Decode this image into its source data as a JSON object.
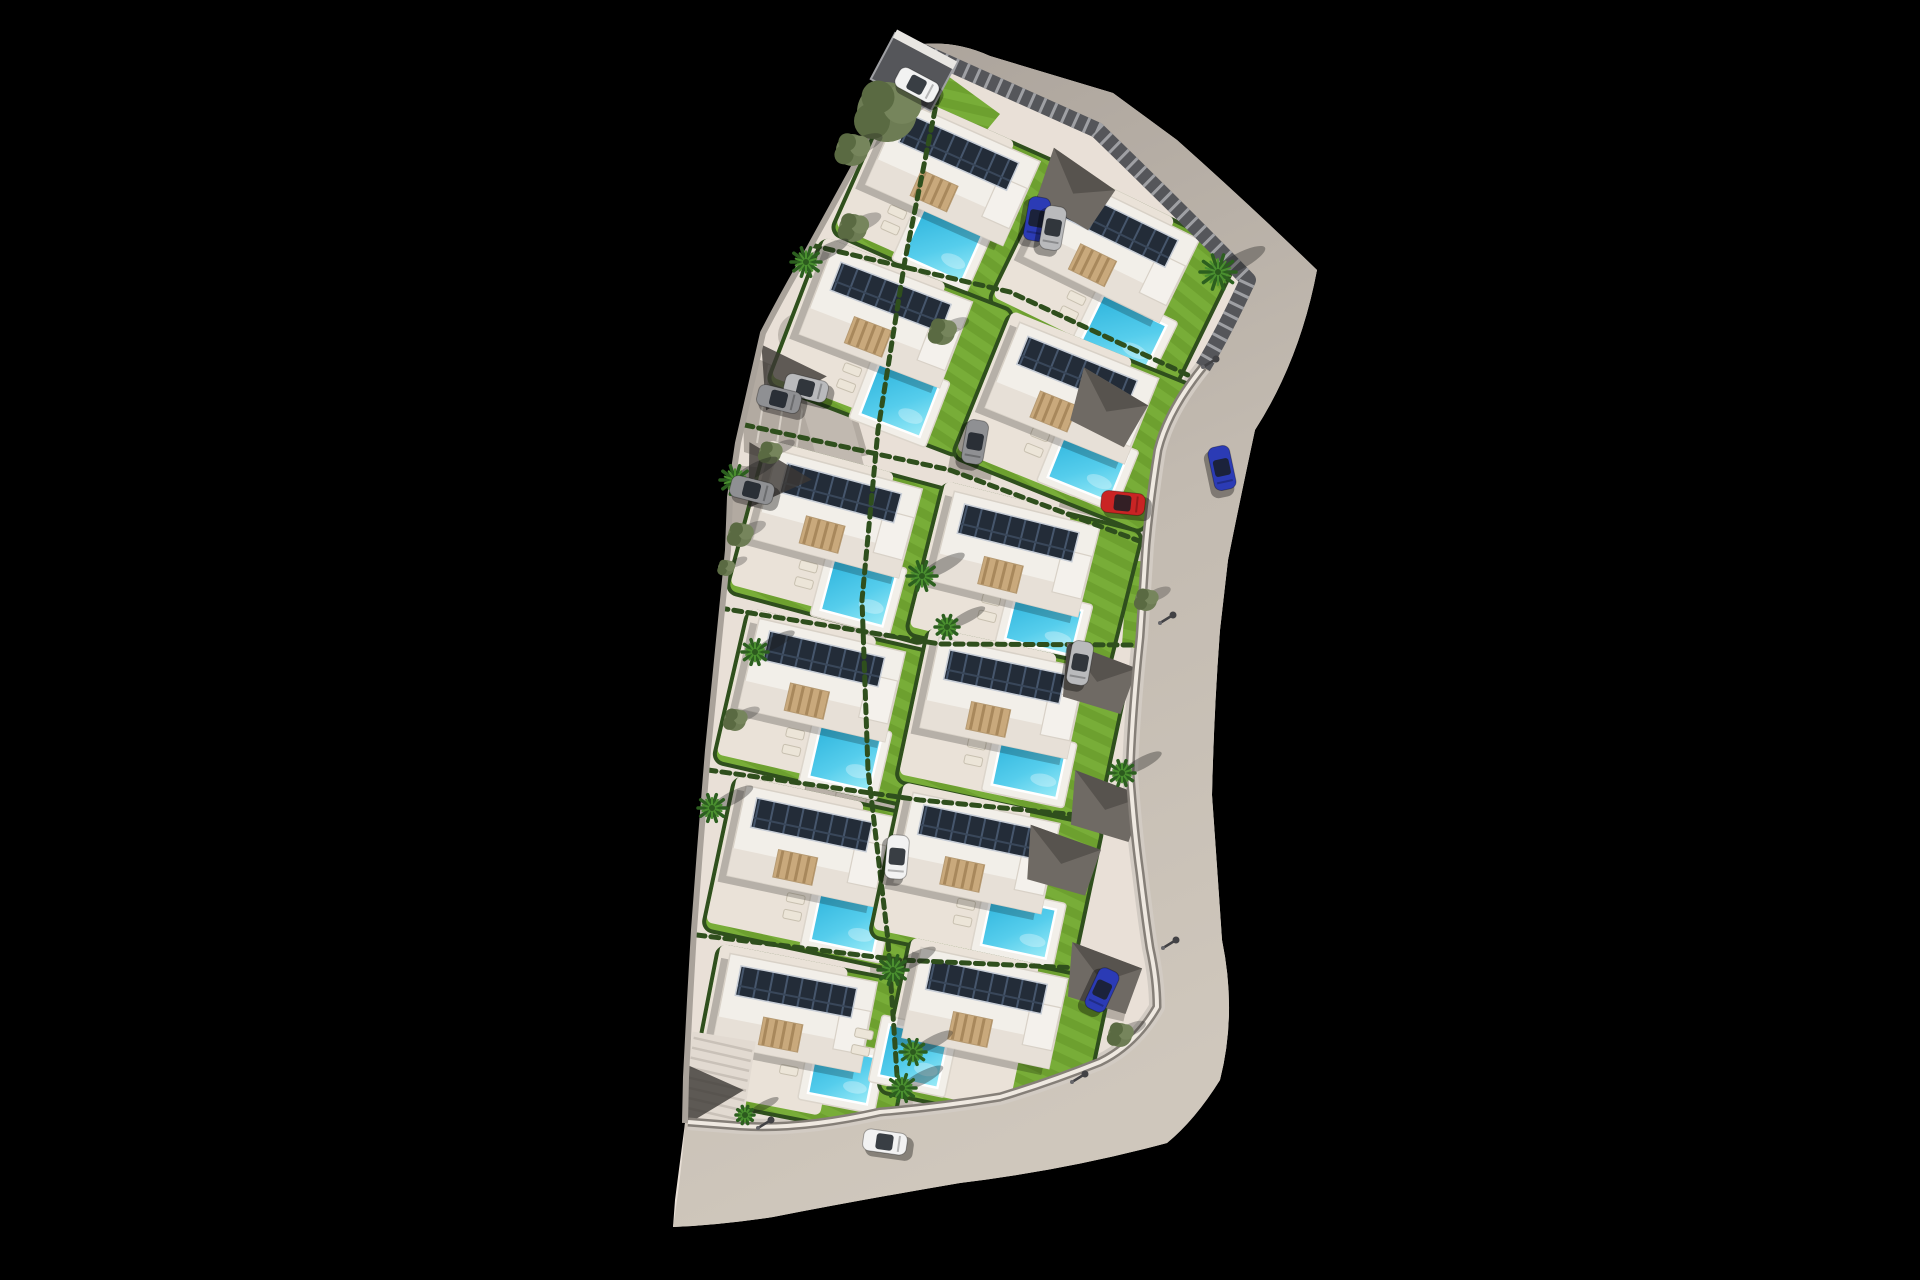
{
  "meta": {
    "title": "Aerial 3D masterplan render of a villa development: 12 detached villas with solar-panel roofs, private pools and gardens inside a walled plot bordered by a curving road, on a black background",
    "canvas_w": 1920,
    "canvas_h": 1280,
    "background": "#000000"
  },
  "counts": {
    "villas": 12,
    "swimming_pools": 12,
    "solar_arrays": 12,
    "cars": 13,
    "carports": 6,
    "palm_trees": 11,
    "olive_trees": 11
  },
  "palette": {
    "ground": "#e9e0d7",
    "terrace": "#eae2d8",
    "road_a": "#a8a098",
    "road_b": "#c3bbb1",
    "road_c": "#cfc7bc",
    "sidewalk": "#d2cbc3",
    "lawn": "#6da02f",
    "lawn_light": "#78ad38",
    "hedge": "#2f4f1d",
    "roof": "#f2efe9",
    "roof_trim": "#d8d1c7",
    "roof_band": "#e7e0d7",
    "shadow": "rgba(0,0,0,0.22)",
    "panel": "#232c38",
    "panel_line": "#46566c",
    "panel_line2": "#39475a",
    "pool_deep": "#2eb4dd",
    "pool_mid": "#55cdec",
    "pool_light": "#9bebf7",
    "deck": "#f2efe9",
    "fence_dark": "#55565a",
    "fence_slat": "#9fa0a4",
    "wall_white": "#efe9e1",
    "wall_shadow": "#857f78",
    "stone_wall": "#a9a29a",
    "lot": "#b2aaa1",
    "stripe": "#d6cfc6",
    "plaza": "#b8b0a7",
    "plaza_line": "#a39b91",
    "pergola": "#c9a97c",
    "pergola_dark": "#a8885c",
    "lounger": "#ece5d8",
    "lounger_edge": "#c8c0b0",
    "carport": "#6f6a64",
    "carport_dark": "#57534e",
    "shade": "rgba(60,56,52,0.8)",
    "olive1": "#6d7c54",
    "olive2": "#5a6a42",
    "olive3": "#76855c",
    "palm1": "#2c5f1f",
    "palm2": "#4a8f2f",
    "car_white": "#f2f2f2",
    "car_silver": "#b9babc",
    "car_gray": "#8f9093",
    "car_blue": "#2b3bb5",
    "car_red": "#c92424",
    "glass": "rgba(25,30,38,0.85)",
    "lamp": "#424245",
    "stairs_bg": "#e2dad1",
    "stairs_line": "#c9c1b8"
  },
  "paths": {
    "ground": "M910,46 Q950,38 990,56 L1113,93 L1177,140 Q1250,205 1317,270 Q1300,360 1255,430 Q1240,500 1228,560 L1220,630 Q1214,710 1212,795 Q1218,880 1222,940 Q1237,1013 1220,1080 Q1195,1120 1167,1143 Q1067,1170 960,1183 Q860,1200 773,1217 Q720,1225 673,1227 L675,1200 L685,1123 L686,1077 L690,1000 L694,930 L700,850 L708,750 L718,650 L728,550 L730,497 L738,443 L750,390 L763,333 Q780,300 800,265 Q830,210 855,165 Q880,105 910,46 Z",
    "road": "M910,46 L1097,130 Q1190,220 1248,280 Q1225,330 1203,367 Q1168,410 1158,450 Q1150,500 1146,545 L1140,637 Q1132,713 1130,773 Q1134,830 1140,873 Q1145,915 1150,948 Q1157,980 1157,1007 Q1135,1045 1100,1062 Q1050,1082 1000,1097 Q940,1107 880,1112 Q800,1130 740,1126 L688,1122 L685,1123 Q682,1170 673,1227 Q720,1225 773,1217 Q860,1200 960,1183 Q1067,1170 1167,1143 Q1195,1120 1220,1080 Q1237,1013 1222,940 Q1218,880 1212,795 Q1214,710 1220,630 L1228,560 Q1240,500 1255,430 Q1300,360 1317,270 Q1250,205 1177,140 L1113,93 L990,56 Q950,38 910,46 Z",
    "site_clip": "M910,46 L1097,130 Q1190,220 1248,280 Q1225,330 1203,367 Q1168,410 1158,450 Q1150,500 1146,545 L1140,637 Q1132,713 1130,773 Q1134,830 1140,873 Q1145,915 1150,948 Q1157,980 1157,1007 Q1135,1045 1100,1062 Q1050,1082 1000,1097 Q940,1107 880,1112 Q800,1130 740,1126 L688,1122 L686,1077 L690,1000 L694,930 L700,850 L708,750 L718,650 L728,550 L730,497 L738,443 L750,390 L763,333 Q780,300 800,265 Q830,210 855,165 Q880,105 910,46 Z",
    "fence": "M910,46 L1097,130 Q1190,220 1248,280 Q1225,330 1203,367",
    "wall_low": "M1203,367 Q1168,410 1158,450 Q1150,500 1146,545 L1140,637 Q1132,713 1130,773 Q1134,830 1140,873 Q1145,915 1150,948 Q1157,980 1157,1007 Q1135,1045 1100,1062 Q1050,1082 1000,1097 Q940,1107 880,1112 Q800,1130 740,1126 L688,1122",
    "wall_left": "M910,46 Q880,105 855,165 Q830,210 800,265 Q780,300 763,333 L750,390 L738,443 L730,497 L728,550 L718,650 L708,750 L700,850 L694,930 L690,1000 L686,1077 L685,1123",
    "spine": "M800,335 Q850,470 858,560 Q866,660 870,730 Q884,810 888,880 Q894,980 893,1060 L890,1118"
  },
  "separators": [
    "798,242 1010,292 1220,390",
    "745,425 950,470 1150,545",
    "720,608 940,644 1133,645",
    "708,770 920,800 1130,820",
    "697,935 900,960 1125,970"
  ],
  "divider": "938,95 905,260 878,430 862,600 868,770 888,940 898,1090",
  "lawn_strips": [
    "915,52 1000,114 962,160 884,98",
    "1048,160 1152,254 1122,286 1030,196",
    "1128,560 1150,562 1143,650 1122,645"
  ],
  "parking": {
    "lot1": "742,352 852,400 868,455 800,470 744,452",
    "lot2": "700,462 788,470 800,540 742,545",
    "stripes": 6
  },
  "plaza": {
    "x": 868,
    "y": 792,
    "rot": 12,
    "w": 124,
    "h": 72
  },
  "stubs": [
    {
      "x": 1032,
      "y": 222,
      "rot": 27,
      "w": 100,
      "h": 52
    },
    {
      "x": 1108,
      "y": 498,
      "rot": 16,
      "w": 90,
      "h": 44
    },
    {
      "x": 975,
      "y": 442,
      "rot": 100,
      "w": 70,
      "h": 44
    },
    {
      "x": 1085,
      "y": 988,
      "rot": 13,
      "w": 90,
      "h": 48
    }
  ],
  "stairs": {
    "x": 717,
    "y": 1082,
    "rot": 9,
    "steps": 9
  },
  "shades": [
    {
      "x": 790,
      "y": 378,
      "rot": 10
    },
    {
      "x": 775,
      "y": 478,
      "rot": 15
    },
    {
      "x": 707,
      "y": 1093,
      "rot": 8
    }
  ],
  "gate": {
    "x": 913,
    "y": 72,
    "rot": 28
  },
  "villas": [
    {
      "id": 1,
      "x": 953,
      "y": 173,
      "rot": 24,
      "pool": {
        "dx": 20,
        "dy": 70,
        "w": 64,
        "h": 52
      }
    },
    {
      "id": 2,
      "x": 1112,
      "y": 248,
      "rot": 26,
      "pool": {
        "dx": 48,
        "dy": 72,
        "w": 70,
        "h": 52
      }
    },
    {
      "id": 3,
      "x": 886,
      "y": 318,
      "rot": 21,
      "pool": {
        "dx": 42,
        "dy": 72,
        "w": 64,
        "h": 54
      }
    },
    {
      "id": 4,
      "x": 1072,
      "y": 393,
      "rot": 22,
      "pool": {
        "dx": 42,
        "dy": 62,
        "w": 66,
        "h": 50
      }
    },
    {
      "id": 5,
      "x": 838,
      "y": 514,
      "rot": 15,
      "pool": {
        "dx": 40,
        "dy": 70,
        "w": 64,
        "h": 54
      }
    },
    {
      "id": 6,
      "x": 1016,
      "y": 554,
      "rot": 14,
      "pool": {
        "dx": 44,
        "dy": 62,
        "w": 68,
        "h": 46
      }
    },
    {
      "id": 7,
      "x": 822,
      "y": 680,
      "rot": 13,
      "pool": {
        "dx": 40,
        "dy": 70,
        "w": 62,
        "h": 54
      }
    },
    {
      "id": 8,
      "x": 1003,
      "y": 698,
      "rot": 12,
      "pool": {
        "dx": 40,
        "dy": 62,
        "w": 66,
        "h": 50
      }
    },
    {
      "id": 9,
      "x": 810,
      "y": 846,
      "rot": 12,
      "pool": {
        "dx": 52,
        "dy": 66,
        "w": 64,
        "h": 52
      }
    },
    {
      "id": 10,
      "x": 977,
      "y": 853,
      "rot": 12,
      "pool": {
        "dx": 56,
        "dy": 64,
        "w": 66,
        "h": 50
      }
    },
    {
      "id": 11,
      "x": 795,
      "y": 1013,
      "rot": 11,
      "pool": {
        "dx": 58,
        "dy": 52,
        "w": 60,
        "h": 48
      }
    },
    {
      "id": 12,
      "x": 985,
      "y": 1008,
      "rot": 12,
      "pool": {
        "dx": -60,
        "dy": 62,
        "w": 60,
        "h": 52
      }
    }
  ],
  "carports": [
    {
      "x": 1075,
      "y": 190,
      "rot": 27
    },
    {
      "x": 1108,
      "y": 408,
      "rot": 23
    },
    {
      "x": 1098,
      "y": 678,
      "rot": 13
    },
    {
      "x": 1106,
      "y": 806,
      "rot": 13
    },
    {
      "x": 1062,
      "y": 860,
      "rot": 12
    },
    {
      "x": 1103,
      "y": 978,
      "rot": 13
    }
  ],
  "trees": [
    {
      "t": "olive",
      "x": 887,
      "y": 112,
      "r": 30
    },
    {
      "t": "olive",
      "x": 852,
      "y": 150,
      "r": 16
    },
    {
      "t": "olive",
      "x": 853,
      "y": 228,
      "r": 14
    },
    {
      "t": "palm",
      "x": 806,
      "y": 262,
      "r": 15
    },
    {
      "t": "olive",
      "x": 942,
      "y": 332,
      "r": 13
    },
    {
      "t": "palm",
      "x": 1218,
      "y": 272,
      "r": 18
    },
    {
      "t": "olive",
      "x": 770,
      "y": 453,
      "r": 11
    },
    {
      "t": "palm",
      "x": 735,
      "y": 480,
      "r": 15
    },
    {
      "t": "olive",
      "x": 740,
      "y": 535,
      "r": 12
    },
    {
      "t": "olive",
      "x": 726,
      "y": 568,
      "r": 8
    },
    {
      "t": "palm",
      "x": 922,
      "y": 576,
      "r": 15
    },
    {
      "t": "palm",
      "x": 947,
      "y": 627,
      "r": 12
    },
    {
      "t": "olive",
      "x": 1146,
      "y": 600,
      "r": 11
    },
    {
      "t": "palm",
      "x": 755,
      "y": 652,
      "r": 13
    },
    {
      "t": "olive",
      "x": 735,
      "y": 720,
      "r": 11
    },
    {
      "t": "palm",
      "x": 712,
      "y": 808,
      "r": 14
    },
    {
      "t": "palm",
      "x": 1122,
      "y": 773,
      "r": 13
    },
    {
      "t": "palm",
      "x": 893,
      "y": 970,
      "r": 15
    },
    {
      "t": "palm",
      "x": 902,
      "y": 1088,
      "r": 14
    },
    {
      "t": "palm",
      "x": 745,
      "y": 1115,
      "r": 9
    },
    {
      "t": "olive",
      "x": 1120,
      "y": 1035,
      "r": 12
    },
    {
      "t": "palm",
      "x": 913,
      "y": 1052,
      "r": 13
    }
  ],
  "cars": [
    {
      "c": "car_white",
      "x": 917,
      "y": 85,
      "rot": 28
    },
    {
      "c": "car_blue",
      "x": 1037,
      "y": 219,
      "rot": 100
    },
    {
      "c": "car_silver",
      "x": 1053,
      "y": 228,
      "rot": 100
    },
    {
      "c": "car_silver",
      "x": 806,
      "y": 388,
      "rot": 14
    },
    {
      "c": "car_gray",
      "x": 779,
      "y": 399,
      "rot": 14
    },
    {
      "c": "car_gray",
      "x": 752,
      "y": 490,
      "rot": 14
    },
    {
      "c": "car_gray",
      "x": 975,
      "y": 442,
      "rot": 100
    },
    {
      "c": "car_silver",
      "x": 1080,
      "y": 663,
      "rot": 100
    },
    {
      "c": "car_blue",
      "x": 1222,
      "y": 468,
      "rot": 78
    },
    {
      "c": "car_red",
      "x": 1123,
      "y": 503,
      "rot": 6
    },
    {
      "c": "car_white",
      "x": 897,
      "y": 857,
      "rot": 95
    },
    {
      "c": "car_blue",
      "x": 1102,
      "y": 990,
      "rot": 115
    },
    {
      "c": "car_white",
      "x": 885,
      "y": 1142,
      "rot": 8
    }
  ],
  "lamps": [
    [
      1203,
      367
    ],
    [
      1160,
      623
    ],
    [
      1163,
      948
    ],
    [
      1072,
      1082
    ],
    [
      758,
      1128
    ]
  ]
}
